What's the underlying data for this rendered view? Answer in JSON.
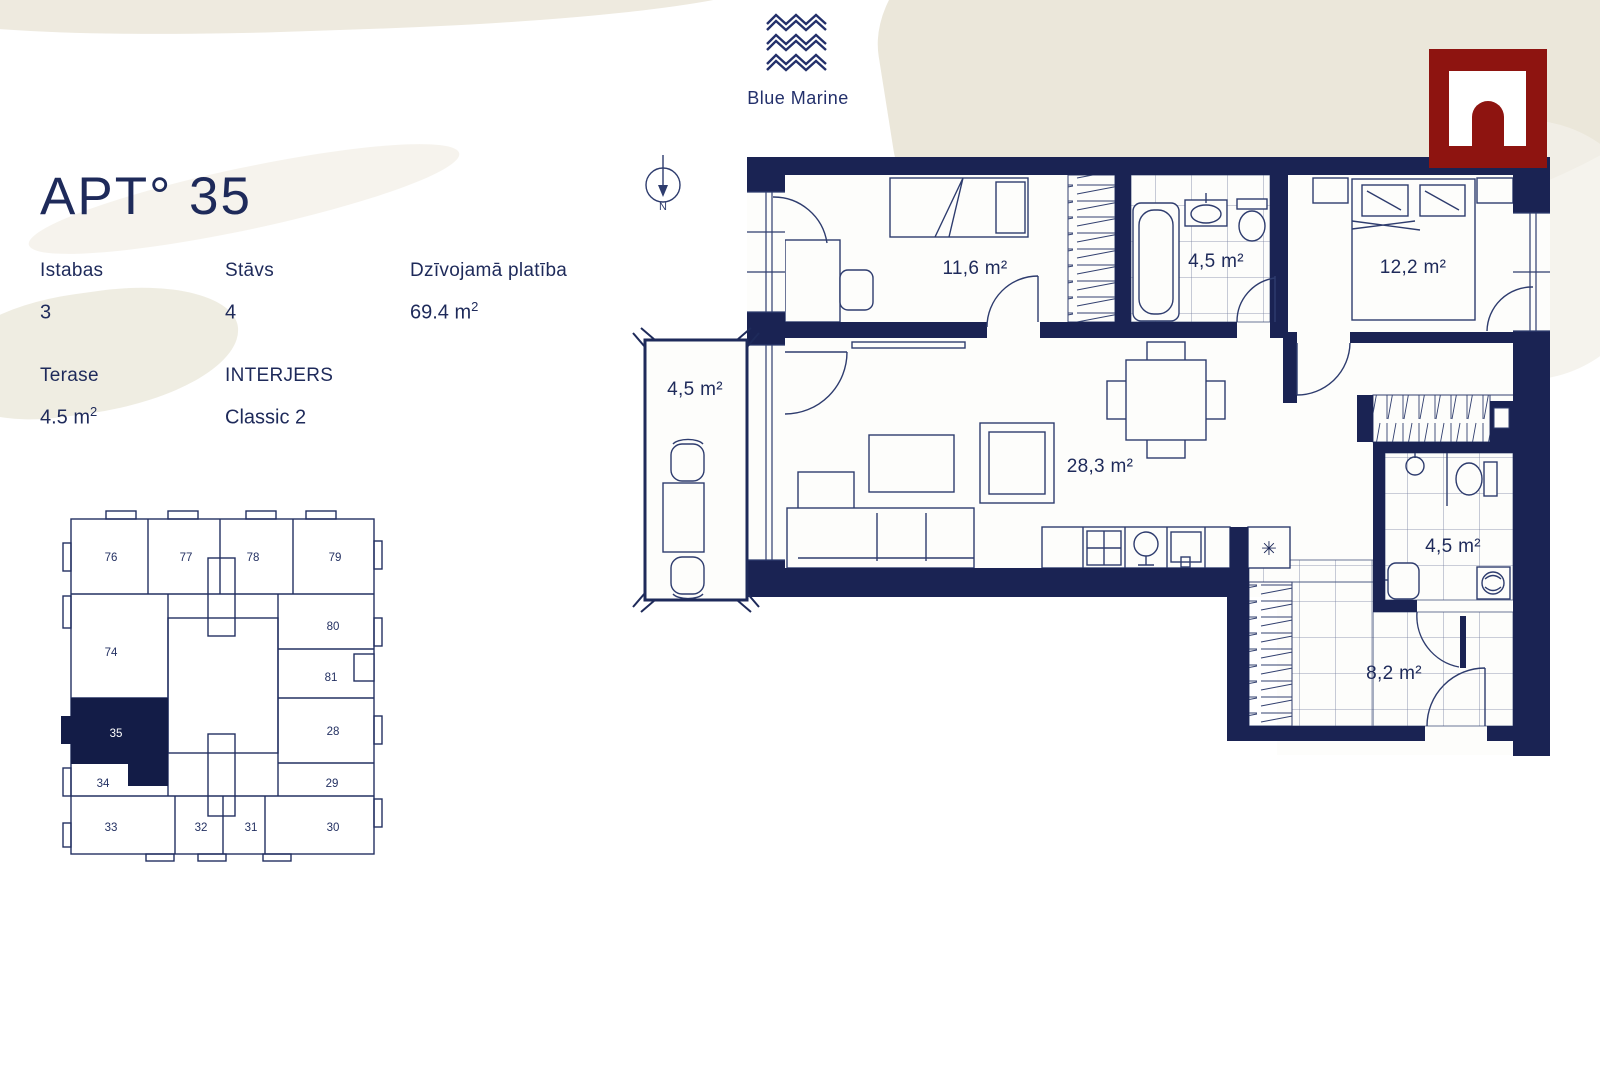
{
  "header": {
    "brand": "Blue Marine"
  },
  "apartment": {
    "title": "APT° 35",
    "details": [
      {
        "label": "Istabas",
        "value": "3",
        "sup": ""
      },
      {
        "label": "Stāvs",
        "value": "4",
        "sup": ""
      },
      {
        "label": "Dzīvojamā platība",
        "value": "69.4 m",
        "sup": "2"
      },
      {
        "label": "Terase",
        "value": "4.5 m",
        "sup": "2"
      },
      {
        "label": "INTERJERS",
        "value": "Classic 2",
        "sup": ""
      }
    ]
  },
  "floor_plan": {
    "compass_label": "N",
    "kitchen_marker": "✳",
    "rooms": [
      {
        "name": "bedroom-1",
        "area": "11,6 m²"
      },
      {
        "name": "bathroom-1",
        "area": "4,5 m²"
      },
      {
        "name": "bedroom-2",
        "area": "12,2 m²"
      },
      {
        "name": "balcony",
        "area": "4,5 m²"
      },
      {
        "name": "living-kitchen",
        "area": "28,3 m²"
      },
      {
        "name": "bathroom-2",
        "area": "4,5 m²"
      },
      {
        "name": "hallway",
        "area": "8,2 m²"
      }
    ]
  },
  "key_plan": {
    "highlighted_unit": "35",
    "units": [
      "76",
      "77",
      "78",
      "79",
      "74",
      "80",
      "81",
      "35",
      "28",
      "34",
      "29",
      "33",
      "32",
      "31",
      "30"
    ]
  },
  "colors": {
    "navy": "#1a2353",
    "maroon": "#8e1410",
    "beige": "#ebe7da"
  }
}
